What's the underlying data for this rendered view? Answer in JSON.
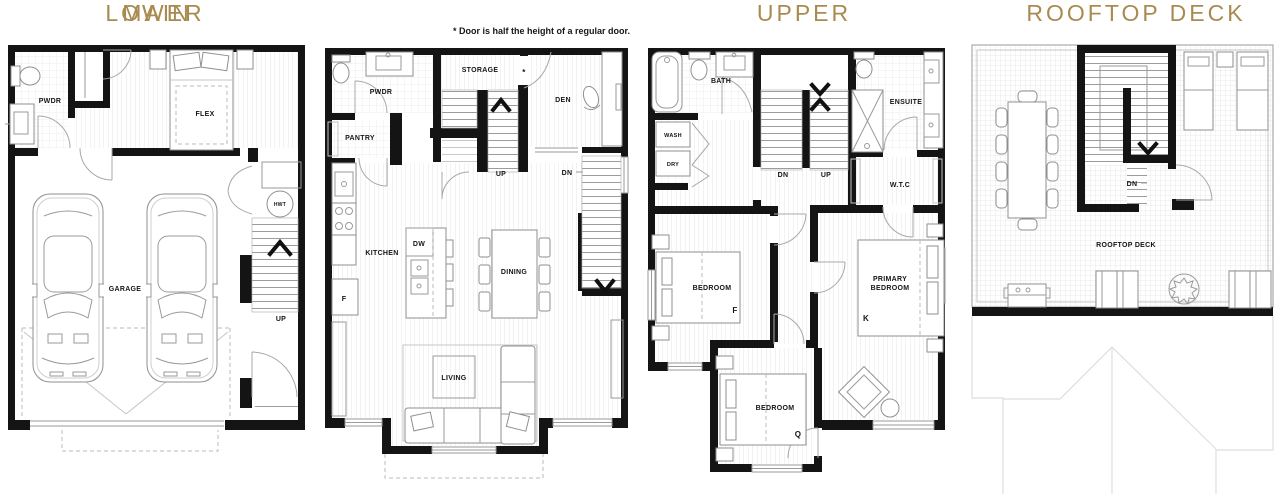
{
  "colors": {
    "accent": "#A98B50",
    "wall": "#141414"
  },
  "note": "* Door is half the height of a regular door.",
  "floors": {
    "lower": {
      "title": "LOWER",
      "labels": {
        "pwdr": "PWDR",
        "flex": "FLEX",
        "hwt": "HWT",
        "garage": "GARAGE",
        "up": "UP"
      }
    },
    "main": {
      "title": "MAIN",
      "labels": {
        "pwdr": "PWDR",
        "pantry": "PANTRY",
        "storage": "STORAGE",
        "asterisk": "*",
        "den": "DEN",
        "up": "UP",
        "dn": "DN",
        "kitchen": "KITCHEN",
        "dw": "DW",
        "fridge": "F",
        "dining": "DINING",
        "living": "LIVING"
      }
    },
    "upper": {
      "title": "UPPER",
      "labels": {
        "bath": "BATH",
        "wash": "WASH",
        "dry": "DRY",
        "ensuite": "ENSUITE",
        "dn": "DN",
        "up": "UP",
        "wtc": "W.T.C",
        "bedroom_f": "BEDROOM",
        "bedroom_f_size": "F",
        "primary_line1": "PRIMARY",
        "primary_line2": "BEDROOM",
        "primary_size": "K",
        "bedroom_q": "BEDROOM",
        "bedroom_q_size": "Q"
      }
    },
    "rooftop": {
      "title": "ROOFTOP DECK",
      "labels": {
        "dn": "DN",
        "deck": "ROOFTOP DECK"
      }
    }
  }
}
